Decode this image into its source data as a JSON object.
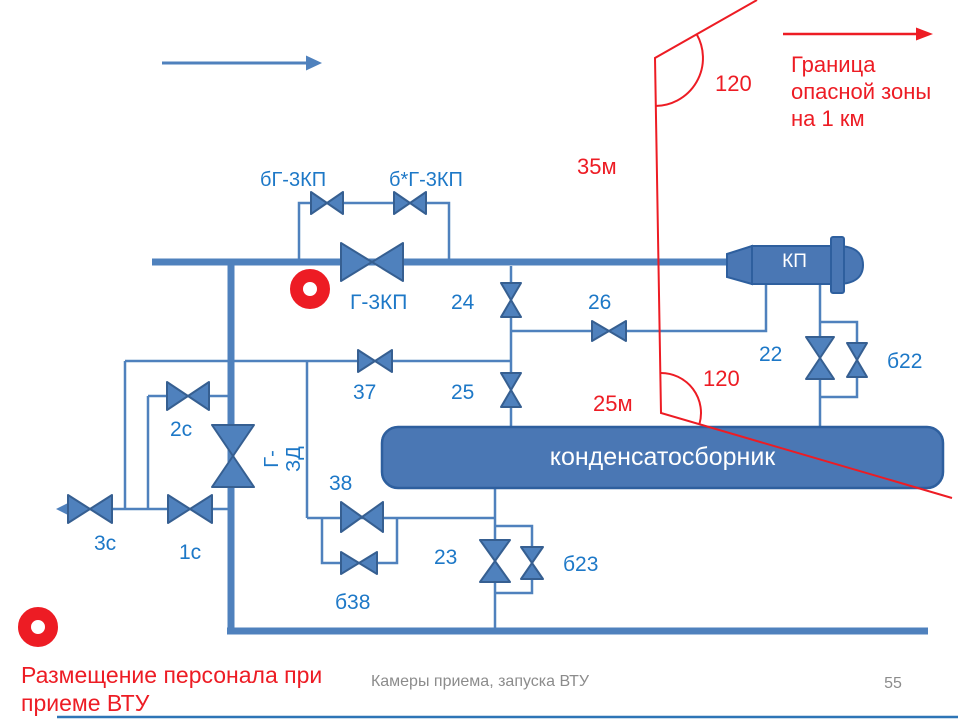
{
  "slide": {
    "footer_caption": "Камеры приема, запуска ВТУ",
    "page_number": "55"
  },
  "legend": {
    "boundary_note": "Граница опасной зоны на 1 км",
    "personnel_note": "Размещение персонала при приеме ВТУ",
    "angle_top": "120",
    "angle_mid": "120",
    "distance_35": "35м",
    "distance_25": "25м"
  },
  "equipment": {
    "receiver": "КП",
    "condensate_collector": "конденсатосборник",
    "gzd_line1": "Г-",
    "gzd_line2": "ЗД"
  },
  "valves": {
    "bg3kp": "бГ-3КП",
    "bstar_g3kp": "б*Г-3КП",
    "g3kp": "Г-3КП",
    "v24": "24",
    "v25": "25",
    "v26": "26",
    "v37": "37",
    "v22": "22",
    "b22": "б22",
    "v2s": "2с",
    "v1s": "1с",
    "v3s": "3с",
    "v38": "38",
    "b38": "б38",
    "v23": "23",
    "b23": "б23"
  },
  "colors": {
    "diagram_blue": "#4f81bd",
    "diagram_blue_dark": "#365f91",
    "label_blue": "#1d78c7",
    "red": "#ed1c24",
    "footer_gray": "#8c8c8c"
  }
}
